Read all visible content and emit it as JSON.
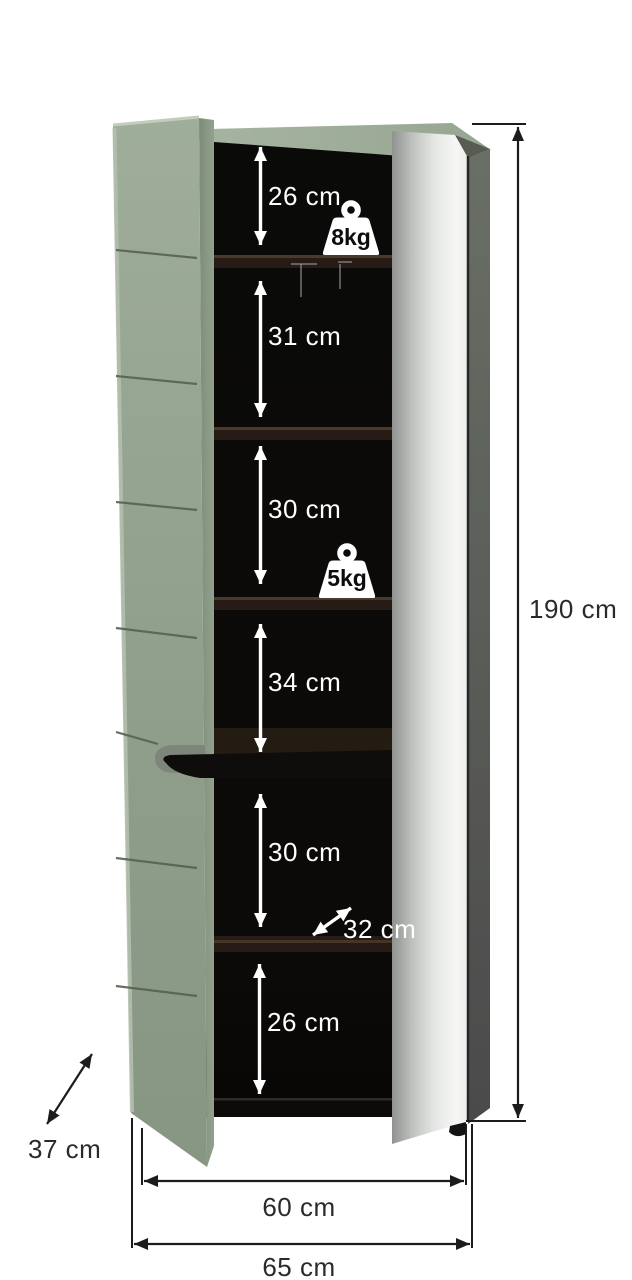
{
  "diagram": {
    "type": "furniture-dimension-diagram",
    "measurements": {
      "shelf_sections": [
        "26 cm",
        "31 cm",
        "30 cm",
        "34 cm",
        "30 cm",
        "26 cm"
      ],
      "inner_depth": "32 cm",
      "total_height": "190 cm",
      "depth": "37 cm",
      "inner_width": "60 cm",
      "total_width": "65 cm"
    },
    "load_capacity": {
      "top_shelf": "8kg",
      "middle_shelf": "5kg"
    },
    "colors": {
      "door_green": "#91a18d",
      "door_green_light": "#b4bfae",
      "cabinet_top_green": "#a6b3a2",
      "interior_black": "#090807",
      "shelf_brown": "#2b211a",
      "mirror_silver": "#d9dbda",
      "side_panel_gray": "#5b5f58",
      "dimension_line": "#1c1c1c",
      "dimension_label_light": "#ffffff"
    }
  }
}
